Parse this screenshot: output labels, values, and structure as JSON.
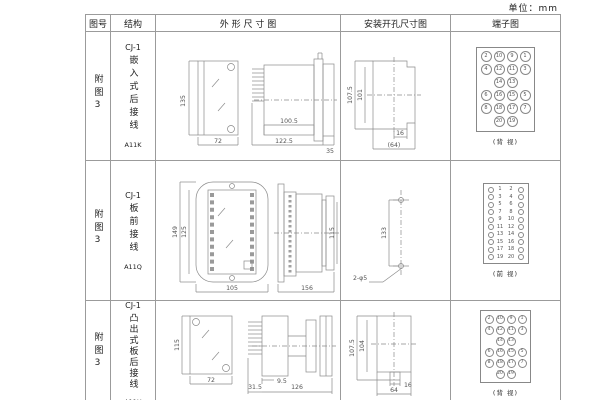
{
  "unit_label": "单位：mm",
  "header": {
    "col_fig": "图号",
    "col_structure": "结构",
    "col_outline": "外 形 尺 寸 图",
    "col_mounting": "安装开孔尺寸图",
    "col_terminal": "端子图"
  },
  "rows": [
    {
      "fig_no": "附图3",
      "model": "CJ-1",
      "structure": "嵌入式后接线",
      "code": "A11K",
      "outline": {
        "front_h": "135",
        "front_w": "72",
        "body_len": "100.5",
        "total_len": "122.5",
        "flange_len": "35"
      },
      "mounting": {
        "h_outer": "107.5",
        "h_inner": "101",
        "w_small": "16",
        "w_large": "(64)"
      },
      "terminal": {
        "view": "(背 视)",
        "pins": [
          "2",
          "10",
          "9",
          "1",
          "4",
          "12",
          "11",
          "3",
          "",
          "14",
          "13",
          "",
          "6",
          "16",
          "15",
          "5",
          "8",
          "18",
          "17",
          "7",
          "",
          "20",
          "19",
          ""
        ]
      }
    },
    {
      "fig_no": "附图3",
      "model": "CJ-1",
      "structure": "板前接线",
      "code": "A11Q",
      "outline": {
        "front_h": "149",
        "inner_h": "125",
        "front_w": "105",
        "side_len": "156",
        "side_h": "115"
      },
      "mounting": {
        "hole_dist": "133",
        "hole_label": "2-φ5"
      },
      "terminal": {
        "view": "(前 视)",
        "pairs": [
          {
            "l": "1",
            "r": "2"
          },
          {
            "l": "3",
            "r": "4"
          },
          {
            "l": "5",
            "r": "6"
          },
          {
            "l": "7",
            "r": "8"
          },
          {
            "l": "9",
            "r": "10"
          },
          {
            "l": "11",
            "r": "12"
          },
          {
            "l": "13",
            "r": "14"
          },
          {
            "l": "15",
            "r": "16"
          },
          {
            "l": "17",
            "r": "18"
          },
          {
            "l": "19",
            "r": "20"
          }
        ]
      }
    },
    {
      "fig_no": "附图3",
      "model": "CJ-1",
      "structure": "凸出式板后接线",
      "code": "A11H",
      "outline": {
        "front_h": "115",
        "front_w": "72",
        "pin_len": "31.5",
        "offset": "9.5",
        "body_len": "126"
      },
      "mounting": {
        "h_outer": "107.5",
        "h_inner": "104",
        "w_small": "16",
        "w_large": "64"
      },
      "terminal": {
        "view": "(背 视)",
        "pins": [
          "2",
          "10",
          "9",
          "1",
          "4",
          "12",
          "11",
          "3",
          "",
          "14",
          "13",
          "",
          "6",
          "16",
          "15",
          "5",
          "8",
          "18",
          "17",
          "7",
          "",
          "20",
          "19",
          ""
        ]
      }
    }
  ]
}
